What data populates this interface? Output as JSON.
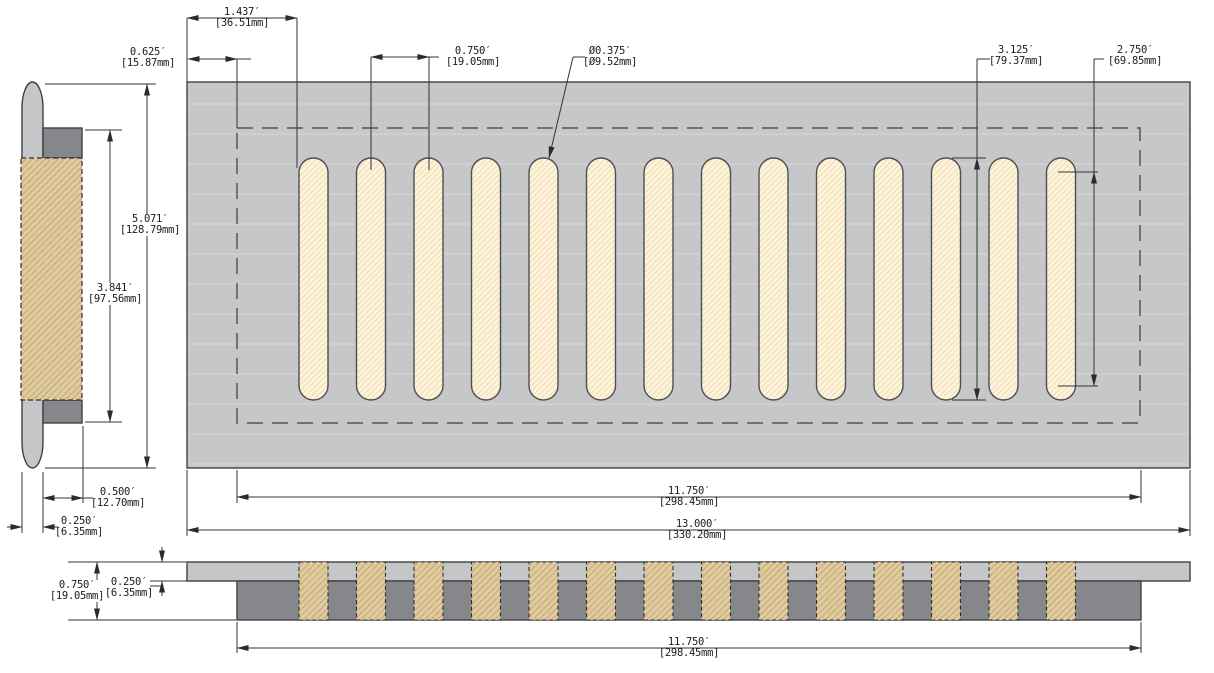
{
  "drawing": {
    "type": "floor-vent-register-technical-drawing",
    "slots": {
      "count": 14,
      "first_left": 299,
      "pitch": 57.5,
      "top": 158,
      "width": 29,
      "height": 242
    },
    "profile_slots": {
      "top": 562,
      "height": 58
    }
  },
  "dimensions": {
    "slot_offset": {
      "in": "1.437′",
      "mm": "[36.51mm]"
    },
    "edge_margin": {
      "in": "0.625′",
      "mm": "[15.87mm]"
    },
    "slot_pitch": {
      "in": "0.750′",
      "mm": "[19.05mm]"
    },
    "slot_dia": {
      "in": "Ø0.375′",
      "mm": "[Ø9.52mm]"
    },
    "slot_height": {
      "in": "3.125′",
      "mm": "[79.37mm]"
    },
    "slot_straight": {
      "in": "2.750′",
      "mm": "[69.85mm]"
    },
    "overall_height": {
      "in": "5.071′",
      "mm": "[128.79mm]"
    },
    "inner_height": {
      "in": "3.841′",
      "mm": "[97.56mm]"
    },
    "duct_depth": {
      "in": "0.500′",
      "mm": "[12.70mm]"
    },
    "flange_thickness": {
      "in": "0.250′",
      "mm": "[6.35mm]"
    },
    "duct_width": {
      "in": "11.750′",
      "mm": "[298.45mm]"
    },
    "overall_width": {
      "in": "13.000′",
      "mm": "[330.20mm]"
    },
    "profile_height": {
      "in": "0.750′",
      "mm": "[19.05mm]"
    },
    "faceplate_thickness": {
      "in": "0.250′",
      "mm": "[6.35mm]"
    },
    "profile_duct_width": {
      "in": "11.750′",
      "mm": "[298.45mm]"
    }
  },
  "colors": {
    "plate": "#c6c7c9",
    "panel-light": "#c4c6c8",
    "panel-dark": "#85878b",
    "slot-fill": "#fcf4dd",
    "slot-hatch": "#eecb8e",
    "tan-fill": "#e0cb9f",
    "tan-hatch": "#b3955f",
    "edge": "#3e4145",
    "dash": "#53565b",
    "dim": "#333333"
  }
}
